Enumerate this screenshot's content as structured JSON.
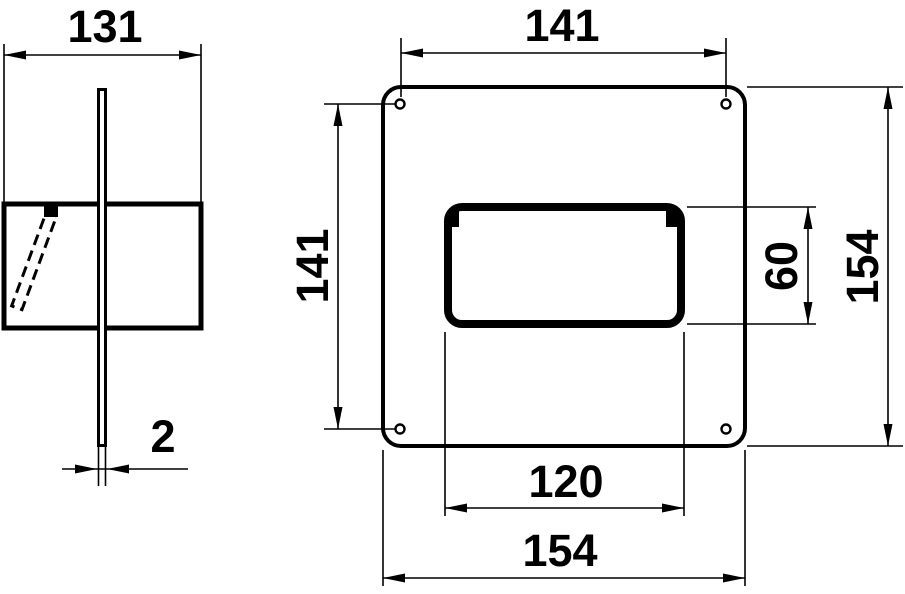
{
  "colors": {
    "ink": "#000000",
    "background": "#ffffff"
  },
  "dimensions": {
    "side_view_width": "131",
    "plate_thickness": "2",
    "hole_spacing_horizontal": "141",
    "hole_spacing_vertical": "141",
    "opening_width": "120",
    "opening_height": "60",
    "plate_width": "154",
    "plate_height": "154"
  }
}
